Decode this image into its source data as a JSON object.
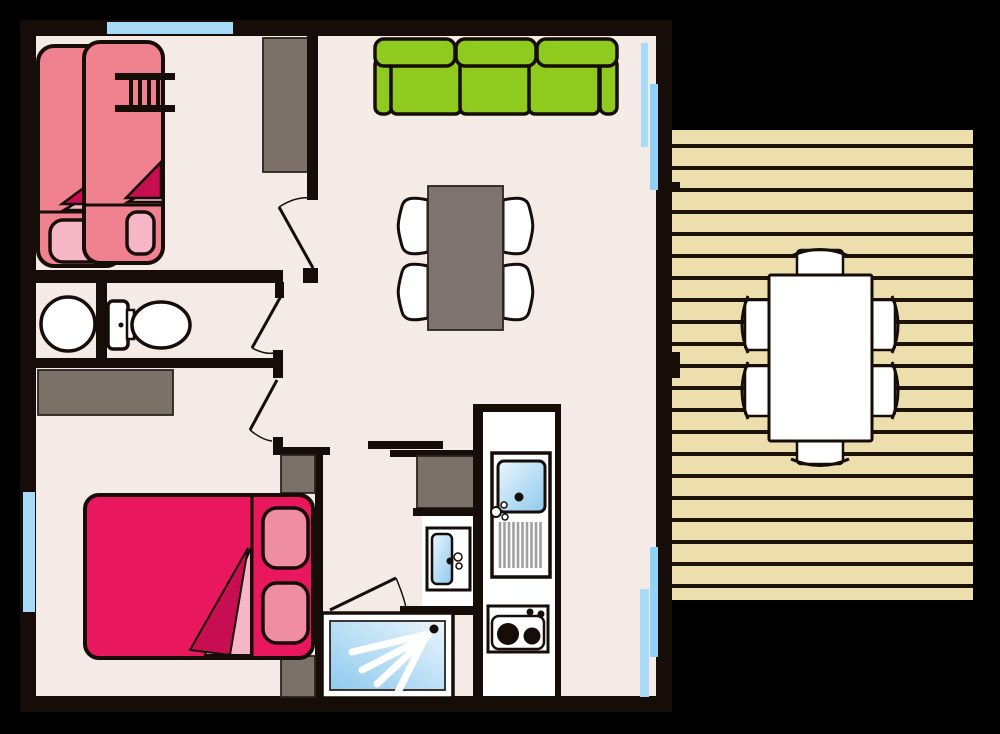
{
  "scene": {
    "kind": "floor-plan",
    "description": "Top-view floor plan of a small holiday home / mobile home with attached wooden terrace",
    "width_px": 1000,
    "height_px": 734
  },
  "colors": {
    "background": "#000000",
    "wall": "#160d08",
    "furn_edge": "#2b2320",
    "floor": "#f4ebe7",
    "white": "#ffffff",
    "deck": "#ecdfad",
    "deck_line": "#1c130a",
    "taupe": "#7c7168",
    "table_gray": "#7e736f",
    "sofa_green": "#8fca1f",
    "bed_pink": "#f0818f",
    "bed_crimson": "#e9175e",
    "pillow_light": "#f5b6c6",
    "pillow_mid": "#ef8da3",
    "blanket_dark": "#c60e51",
    "window_blue": "#a8dbf8",
    "window_blue_2": "#8fd2f5",
    "water_light": "#eaf6fd",
    "water_deep": "#8ec9ee",
    "drain_gray": "#a0a0a0"
  },
  "rooms": [
    {
      "name": "bunk-bedroom",
      "position": "top-left",
      "furniture": [
        "single-bed-left",
        "single-bed-right",
        "bunk-ladder",
        "wardrobe",
        "window-top"
      ]
    },
    {
      "name": "wc-bathroom",
      "position": "mid-left",
      "furniture": [
        "round-washbasin",
        "toilet"
      ]
    },
    {
      "name": "double-bedroom",
      "position": "bottom-left",
      "furniture": [
        "dresser",
        "double-bed",
        "pillow-top",
        "pillow-bottom",
        "nightstand-top",
        "nightstand-bottom",
        "window-left"
      ]
    },
    {
      "name": "shower-room",
      "position": "bottom-center",
      "furniture": [
        "counter",
        "washbasin",
        "shower-tray"
      ]
    },
    {
      "name": "kitchen",
      "position": "bottom-center",
      "furniture": [
        "sink-with-drainer",
        "two-burner-stove"
      ]
    },
    {
      "name": "living-dining",
      "position": "center",
      "furniture": [
        "three-seat-sofa",
        "dining-table",
        "four-chairs",
        "sliding-bay-upper",
        "sliding-bay-lower"
      ]
    },
    {
      "name": "terrace-deck",
      "position": "right",
      "furniture": [
        "outdoor-table",
        "six-outdoor-chairs",
        "wood-planks"
      ]
    }
  ],
  "doors": [
    "bunk-bedroom-door",
    "wc-bathroom-door",
    "double-bedroom-door",
    "shower-room-door"
  ],
  "counts": {
    "indoor_dining_chairs": 4,
    "outdoor_chairs": 6,
    "sofa_seats": 3,
    "stove_burners": 2,
    "beds_single": 2,
    "beds_double": 1
  }
}
